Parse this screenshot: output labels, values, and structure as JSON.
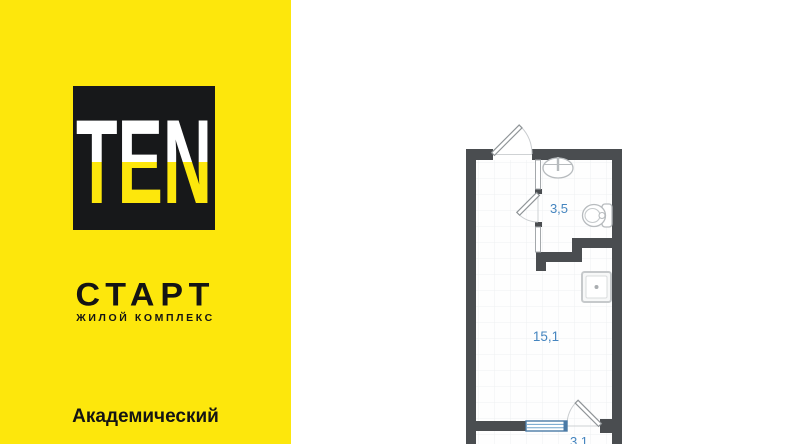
{
  "brand_panel": {
    "background_color": "#fde70c",
    "logo_text": "TEN",
    "complex_name": "СТАРТ",
    "complex_subtitle": "ЖИЛОЙ КОМПЛЕКС",
    "district": "Академический"
  },
  "floor_plan": {
    "type": "studio-apartment-plan",
    "wall_color": "#4a4d50",
    "area_label_color": "#4585bf",
    "rooms": [
      {
        "name": "bathroom",
        "area_label": "3,5"
      },
      {
        "name": "main-room",
        "area_label": "15,1"
      },
      {
        "name": "balcony",
        "area_label": "3,1"
      }
    ],
    "fixtures": [
      "entrance-door",
      "bathroom-door",
      "balcony-door",
      "window",
      "sink-icon",
      "toilet-icon",
      "washer-icon"
    ]
  }
}
